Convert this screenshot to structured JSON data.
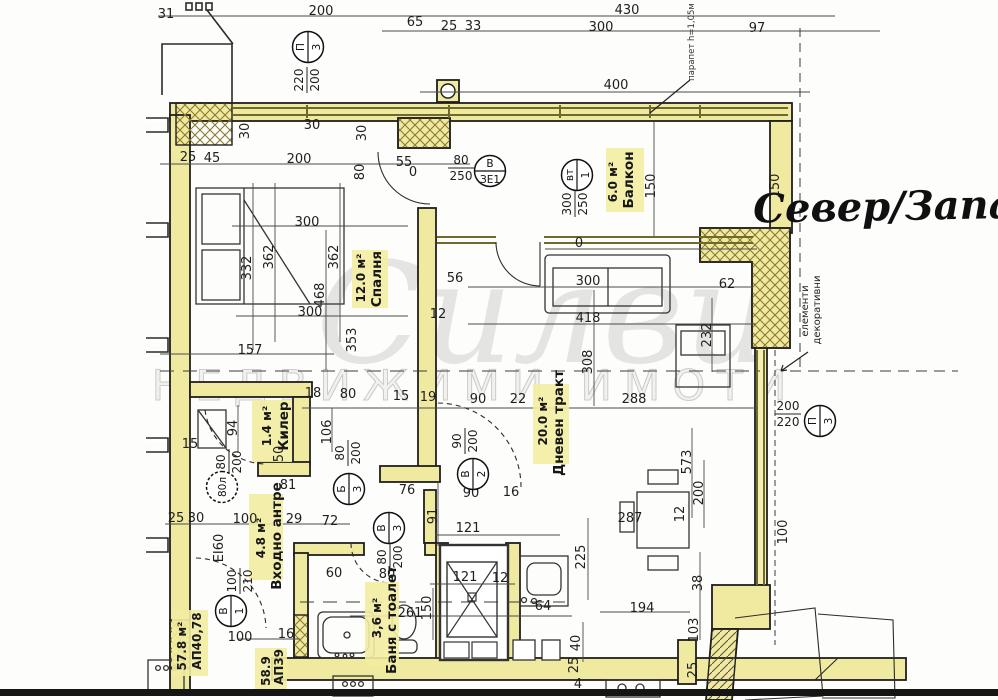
{
  "compass": {
    "text": "Север/Запад"
  },
  "watermark": {
    "script": "Силви",
    "caption": "НЕДВИЖИМИ ИМОТИ"
  },
  "notes": {
    "parapet": "парапет h=1,05м",
    "deco_line1": "декоративни",
    "deco_line2": "елементи",
    "fire_rating": "EI60"
  },
  "apartment_labels": [
    {
      "line1": "АП40,78",
      "line2": "57.8 м²"
    },
    {
      "line1": "АП39",
      "line2": "58.9"
    }
  ],
  "rooms": [
    {
      "name": "Балкон",
      "area": "6.0 м²"
    },
    {
      "name": "Спалня",
      "area": "12.0 м²"
    },
    {
      "name": "Килер",
      "area": "1.4 м²"
    },
    {
      "name": "Дневен тракт",
      "area": "20.0 м²"
    },
    {
      "name": "Входно антре",
      "area": "4.8 м²"
    },
    {
      "name": "Баня с тоалет",
      "area": "3,6 м²"
    }
  ],
  "colors": {
    "wall_yellow": "#f0e9a0",
    "line": "#1f1f1f",
    "glazing": "#6e6a2e"
  },
  "dimensions": [
    {
      "t": "31",
      "x": 166,
      "y": 18
    },
    {
      "t": "200",
      "x": 321,
      "y": 15
    },
    {
      "t": "430",
      "x": 627,
      "y": 14
    },
    {
      "t": "65",
      "x": 415,
      "y": 26
    },
    {
      "t": "25",
      "x": 449,
      "y": 30
    },
    {
      "t": "33",
      "x": 473,
      "y": 30
    },
    {
      "t": "300",
      "x": 601,
      "y": 31
    },
    {
      "t": "97",
      "x": 757,
      "y": 32
    },
    {
      "t": "400",
      "x": 616,
      "y": 89
    },
    {
      "t": "150",
      "x": 655,
      "y": 186,
      "v": 1
    },
    {
      "t": "150",
      "x": 779,
      "y": 186,
      "v": 1
    },
    {
      "t": "30",
      "x": 249,
      "y": 131,
      "v": 1
    },
    {
      "t": "30",
      "x": 312,
      "y": 129
    },
    {
      "t": "30",
      "x": 366,
      "y": 133,
      "v": 1
    },
    {
      "t": "80",
      "x": 364,
      "y": 172,
      "v": 1
    },
    {
      "t": "25",
      "x": 188,
      "y": 161
    },
    {
      "t": "45",
      "x": 212,
      "y": 162
    },
    {
      "t": "200",
      "x": 299,
      "y": 163
    },
    {
      "t": "55",
      "x": 404,
      "y": 166
    },
    {
      "t": "0",
      "x": 413,
      "y": 176
    },
    {
      "t": "300",
      "x": 307,
      "y": 226
    },
    {
      "t": "362",
      "x": 273,
      "y": 257,
      "v": 1
    },
    {
      "t": "332",
      "x": 251,
      "y": 268,
      "v": 1
    },
    {
      "t": "362",
      "x": 338,
      "y": 257,
      "v": 1
    },
    {
      "t": "468",
      "x": 324,
      "y": 295,
      "v": 1
    },
    {
      "t": "300",
      "x": 310,
      "y": 316
    },
    {
      "t": "157",
      "x": 250,
      "y": 354
    },
    {
      "t": "353",
      "x": 356,
      "y": 340,
      "v": 1
    },
    {
      "t": "0",
      "x": 579,
      "y": 247
    },
    {
      "t": "300",
      "x": 588,
      "y": 285
    },
    {
      "t": "418",
      "x": 588,
      "y": 322
    },
    {
      "t": "56",
      "x": 455,
      "y": 282
    },
    {
      "t": "12",
      "x": 438,
      "y": 318
    },
    {
      "t": "62",
      "x": 727,
      "y": 288
    },
    {
      "t": "308",
      "x": 592,
      "y": 362,
      "v": 1
    },
    {
      "t": "232",
      "x": 711,
      "y": 335,
      "v": 1
    },
    {
      "t": "18",
      "x": 313,
      "y": 397
    },
    {
      "t": "80",
      "x": 348,
      "y": 398
    },
    {
      "t": "15",
      "x": 401,
      "y": 400
    },
    {
      "t": "19",
      "x": 428,
      "y": 401
    },
    {
      "t": "90",
      "x": 478,
      "y": 403
    },
    {
      "t": "22",
      "x": 518,
      "y": 403
    },
    {
      "t": "288",
      "x": 634,
      "y": 403
    },
    {
      "t": "94",
      "x": 237,
      "y": 428,
      "v": 1
    },
    {
      "t": "106",
      "x": 331,
      "y": 432,
      "v": 1
    },
    {
      "t": "50",
      "x": 283,
      "y": 454,
      "v": 1
    },
    {
      "t": "15",
      "x": 190,
      "y": 448
    },
    {
      "t": "81",
      "x": 288,
      "y": 489
    },
    {
      "t": "76",
      "x": 407,
      "y": 494
    },
    {
      "t": "25",
      "x": 176,
      "y": 522
    },
    {
      "t": "30",
      "x": 196,
      "y": 522
    },
    {
      "t": "100",
      "x": 245,
      "y": 523
    },
    {
      "t": "29",
      "x": 294,
      "y": 523
    },
    {
      "t": "72",
      "x": 330,
      "y": 525
    },
    {
      "t": "90",
      "x": 471,
      "y": 497
    },
    {
      "t": "16",
      "x": 511,
      "y": 496
    },
    {
      "t": "91",
      "x": 437,
      "y": 516,
      "v": 1
    },
    {
      "t": "121",
      "x": 468,
      "y": 532
    },
    {
      "t": "573",
      "x": 691,
      "y": 462,
      "v": 1
    },
    {
      "t": "200",
      "x": 703,
      "y": 493,
      "v": 1
    },
    {
      "t": "287",
      "x": 630,
      "y": 522
    },
    {
      "t": "38",
      "x": 702,
      "y": 583,
      "v": 1
    },
    {
      "t": "194",
      "x": 642,
      "y": 612
    },
    {
      "t": "103",
      "x": 698,
      "y": 630,
      "v": 1
    },
    {
      "t": "100",
      "x": 787,
      "y": 532,
      "v": 1
    },
    {
      "t": "12",
      "x": 684,
      "y": 514,
      "v": 1
    },
    {
      "t": "25",
      "x": 697,
      "y": 670,
      "v": 1
    },
    {
      "t": "60",
      "x": 334,
      "y": 577
    },
    {
      "t": "80",
      "x": 387,
      "y": 578
    },
    {
      "t": "121",
      "x": 465,
      "y": 581
    },
    {
      "t": "12",
      "x": 500,
      "y": 582
    },
    {
      "t": "150",
      "x": 431,
      "y": 608,
      "v": 1
    },
    {
      "t": "261",
      "x": 410,
      "y": 617
    },
    {
      "t": "64",
      "x": 543,
      "y": 610
    },
    {
      "t": "225",
      "x": 585,
      "y": 557,
      "v": 1
    },
    {
      "t": "40",
      "x": 580,
      "y": 643,
      "v": 1
    },
    {
      "t": "25",
      "x": 578,
      "y": 665,
      "v": 1
    },
    {
      "t": "4",
      "x": 578,
      "y": 688
    },
    {
      "t": "100",
      "x": 240,
      "y": 641
    },
    {
      "t": "16",
      "x": 286,
      "y": 638
    }
  ],
  "fractions": [
    {
      "a": "80",
      "b": "250",
      "x": 461,
      "y": 167
    },
    {
      "a": "300",
      "b": "250",
      "x": 574,
      "y": 204,
      "v": 1
    },
    {
      "a": "220",
      "b": "200",
      "x": 306,
      "y": 80,
      "v": 1
    },
    {
      "a": "90",
      "b": "200",
      "x": 464,
      "y": 441,
      "v": 1
    },
    {
      "a": "80",
      "b": "200",
      "x": 347,
      "y": 453,
      "v": 1
    },
    {
      "a": "80",
      "b": "200",
      "x": 389,
      "y": 557,
      "v": 1
    },
    {
      "a": "100",
      "b": "210",
      "x": 239,
      "y": 581,
      "v": 1
    },
    {
      "a": "200",
      "b": "220",
      "x": 788,
      "y": 413
    },
    {
      "a": "80",
      "b": "200",
      "x": 228,
      "y": 462,
      "v": 1
    }
  ],
  "symbols": [
    {
      "a": "П",
      "b": "3",
      "x": 308,
      "y": 47,
      "v": 1
    },
    {
      "a": "В",
      "b": "ЗЕ1",
      "x": 490,
      "y": 171
    },
    {
      "a": "вт",
      "b": "1",
      "x": 577,
      "y": 175,
      "v": 1
    },
    {
      "a": "Б",
      "b": "3",
      "x": 349,
      "y": 489,
      "v": 1
    },
    {
      "a": "В",
      "b": "2",
      "x": 473,
      "y": 474,
      "v": 1
    },
    {
      "a": "В",
      "b": "3",
      "x": 389,
      "y": 528,
      "v": 1
    },
    {
      "a": "В",
      "b": "1",
      "x": 231,
      "y": 611,
      "v": 1
    },
    {
      "a": "П",
      "b": "3",
      "x": 820,
      "y": 421,
      "v": 1
    },
    {
      "a": "80л",
      "b": "",
      "x": 222,
      "y": 487,
      "v": 1,
      "dash": 1
    }
  ]
}
